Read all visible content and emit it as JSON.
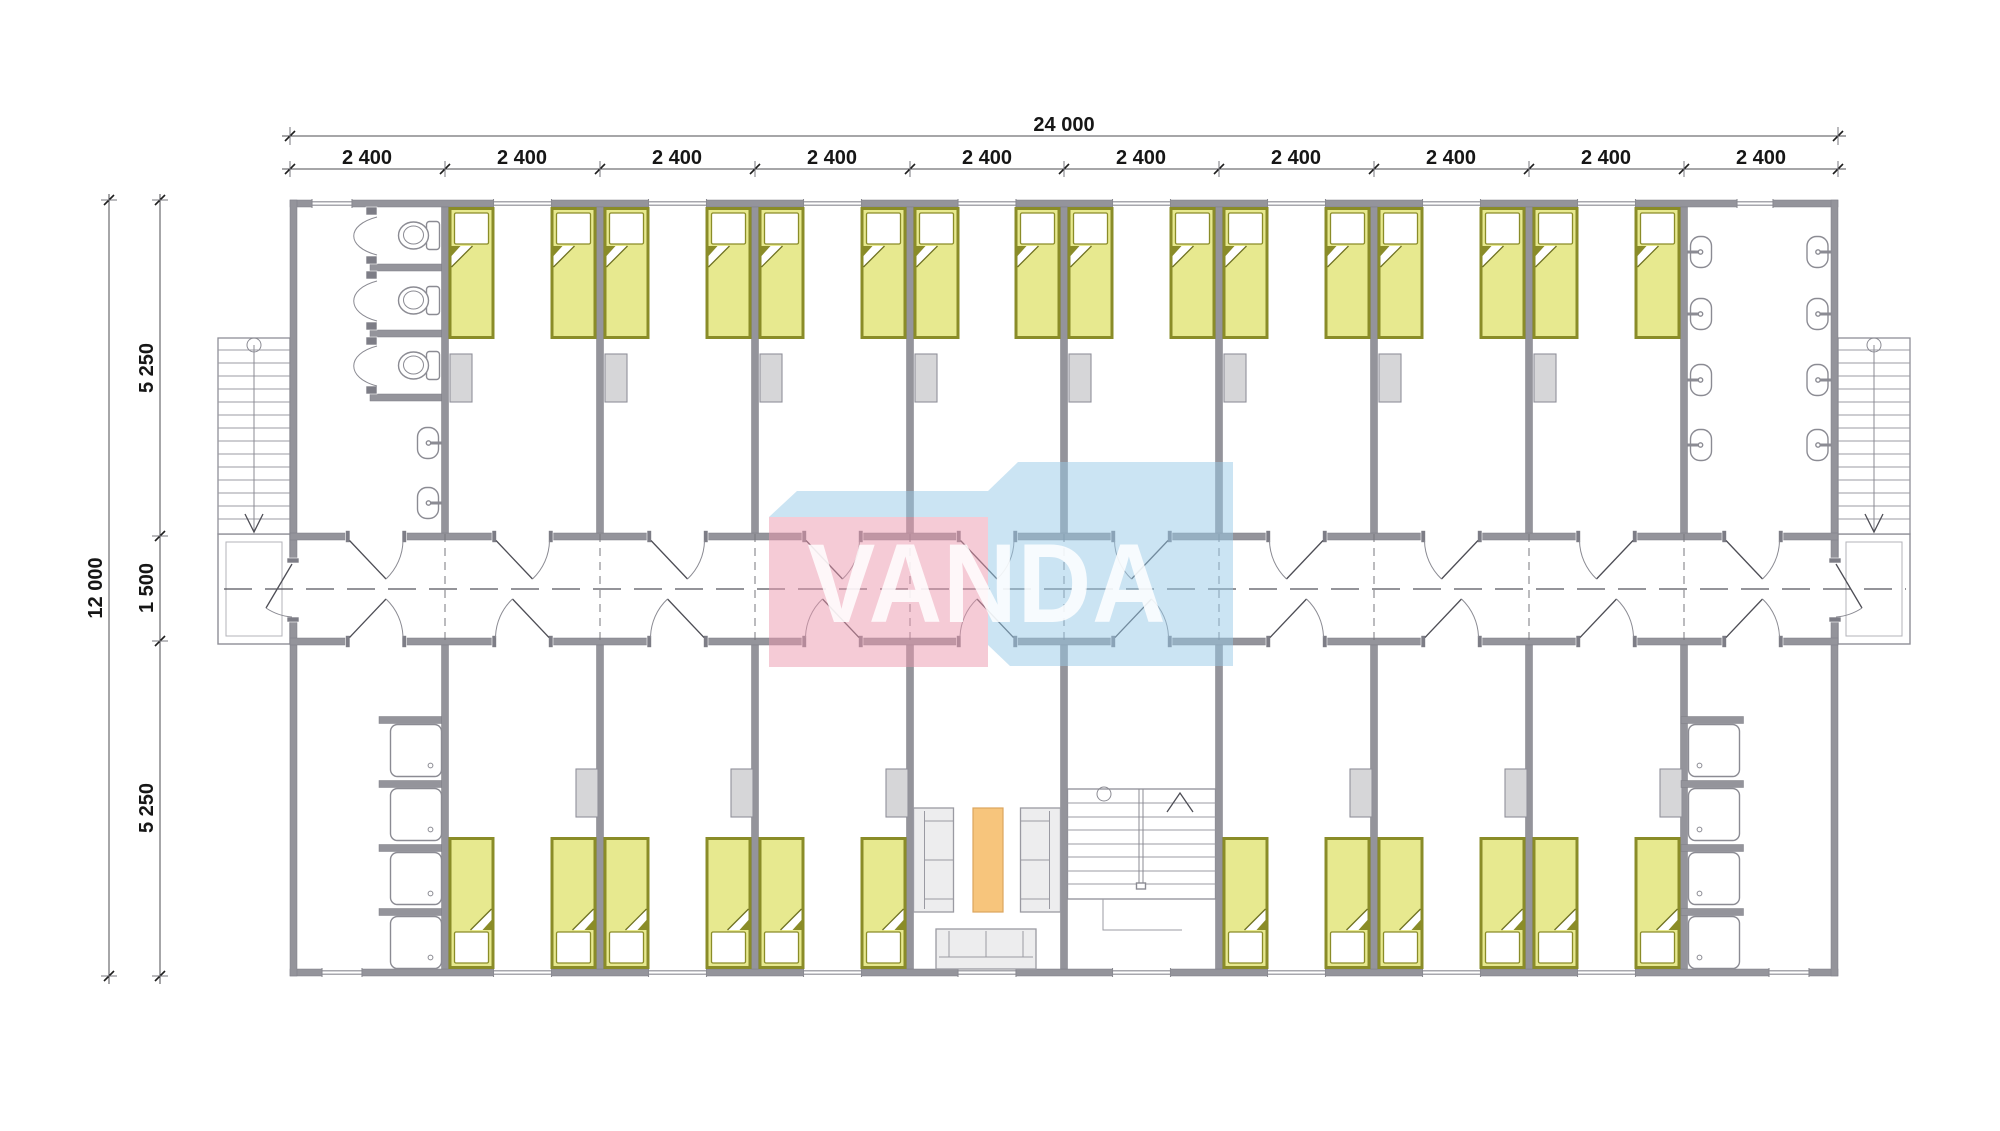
{
  "watermark": {
    "text": "VANDA",
    "front_color": "#ec97ad",
    "side_color": "#98c9e8",
    "letter_color": "#ffffff"
  },
  "dimensions": {
    "top": {
      "total": "24 000",
      "segments": [
        "2 400",
        "2 400",
        "2 400",
        "2 400",
        "2 400",
        "2 400",
        "2 400",
        "2 400",
        "2 400",
        "2 400"
      ]
    },
    "left": {
      "total": "12 000",
      "segments": [
        "5 250",
        "1 500",
        "5 250"
      ]
    }
  },
  "plan": {
    "type": "floor-plan",
    "fixtures": {
      "beds": 28,
      "bedside_lockers": 14,
      "toilets": 3,
      "wash_basins": 10,
      "showers": 8,
      "sofas": 3,
      "coffee_tables": 1,
      "windows": 20,
      "room_doors": 20,
      "entry_doors": 2,
      "external_staircases": 2,
      "internal_staircases": 1,
      "porches": 2
    }
  },
  "colors": {
    "wall": "#94949b",
    "bed_mattress": "#e7e98f",
    "bed_frame": "#8a8c28",
    "locker": "#d6d6d8",
    "coffee_table": "#f7c57c",
    "sofa": "#ededee",
    "background": "#ffffff"
  }
}
